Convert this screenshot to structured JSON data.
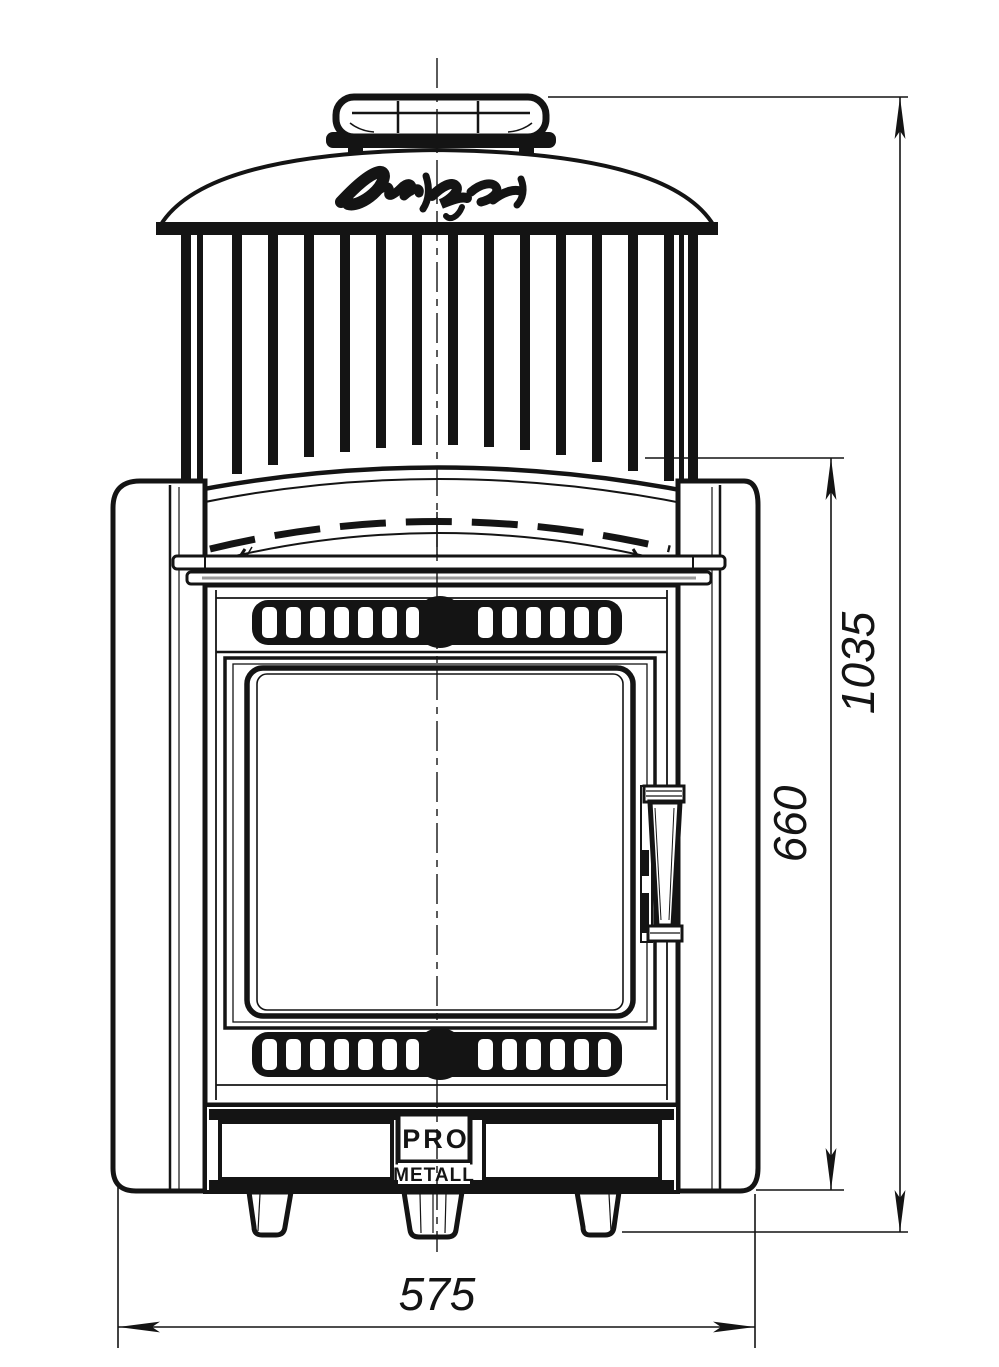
{
  "page": {
    "background": "#ffffff",
    "line_color": "#141414"
  },
  "dimensions": {
    "height_total": "1035",
    "height_body": "660",
    "width": "575"
  },
  "maker_badge": {
    "top": "PRO",
    "bottom": "METALL"
  }
}
